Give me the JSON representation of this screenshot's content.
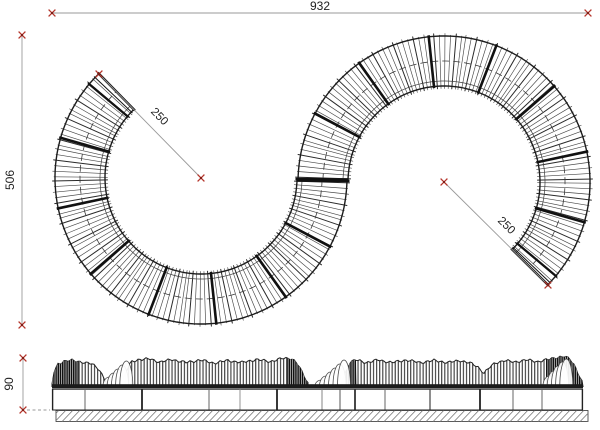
{
  "drawing": {
    "dimensions": {
      "overall_width": "932",
      "overall_depth": "506",
      "left_radius": "250",
      "right_radius": "250",
      "seat_height": "90"
    },
    "colors": {
      "background": "#ffffff",
      "line": "#1c1c1c",
      "slat": "#474747",
      "divider": "#111111",
      "dimension_line": "#9a9a9a",
      "marker_red": "#b5352b",
      "marker_core": "#801d15",
      "text": "#222222",
      "hatch": "#777777"
    }
  }
}
